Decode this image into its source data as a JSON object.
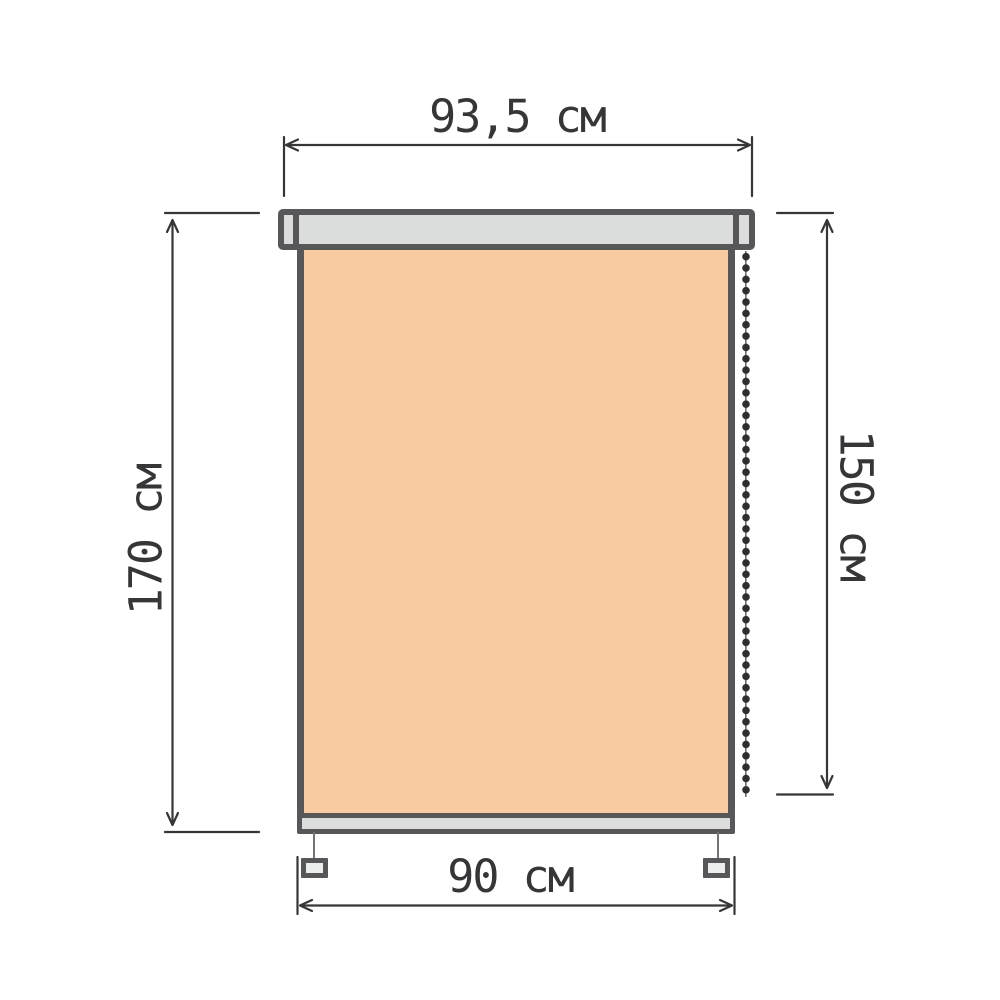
{
  "diagram": {
    "subject": "roller-blind-dimension-drawing",
    "unit": "см",
    "dimensions": {
      "cassette_width": {
        "label": "93,5 см",
        "value": 93.5
      },
      "full_height": {
        "label": "170 см",
        "value": 170
      },
      "fabric_height": {
        "label": "150 см",
        "value": 150
      },
      "fabric_width": {
        "label": "90 см",
        "value": 90
      }
    },
    "colors": {
      "fabric": "#f9cba1",
      "hardware": "#dbdcdc",
      "outline": "#575759",
      "dim": "#363638",
      "bg": "#ffffff"
    }
  }
}
